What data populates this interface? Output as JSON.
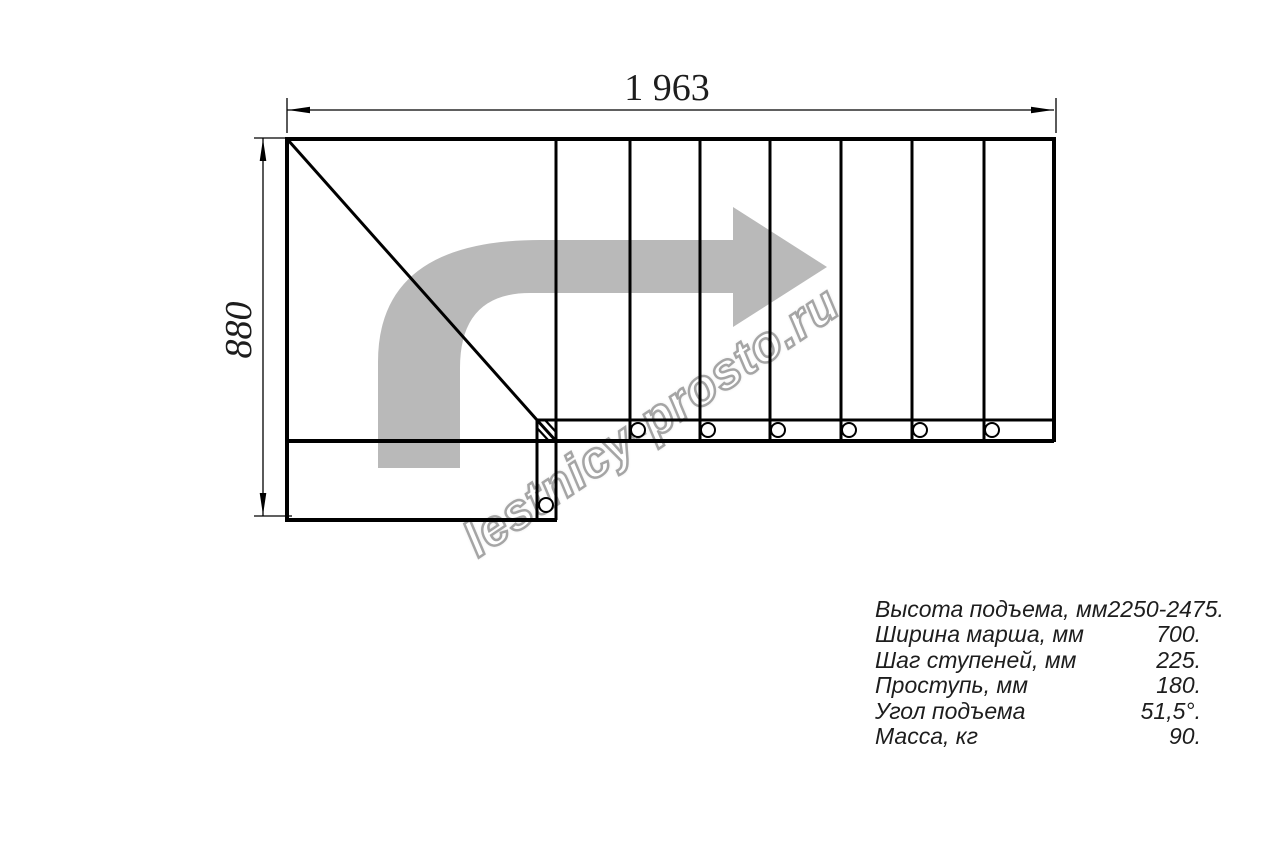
{
  "watermark": {
    "text": "lestnicy-prosto.ru"
  },
  "drawing": {
    "type": "staircase-plan-top-view",
    "width_label": "1 963",
    "height_label": "880",
    "straight_flight_steps": 7,
    "turn": "quarter-turn left-to-right, landing with diagonal winder"
  },
  "specs": {
    "rows": [
      {
        "label": "Высота подъема, мм",
        "value": "2250-2475."
      },
      {
        "label": "Ширина марша, мм",
        "value": "700."
      },
      {
        "label": "Шаг ступеней, мм",
        "value": "225."
      },
      {
        "label": "Проступь, мм",
        "value": "180."
      },
      {
        "label": "Угол подъема",
        "value": "51,5°."
      },
      {
        "label": "Масса, кг",
        "value": "90."
      }
    ]
  },
  "colors": {
    "line": "#000000",
    "arrow_fill": "#b9b9b9",
    "watermark_outline": "#9e9e9e",
    "watermark_fill": "#ffffff",
    "text": "#1d1d1d"
  }
}
